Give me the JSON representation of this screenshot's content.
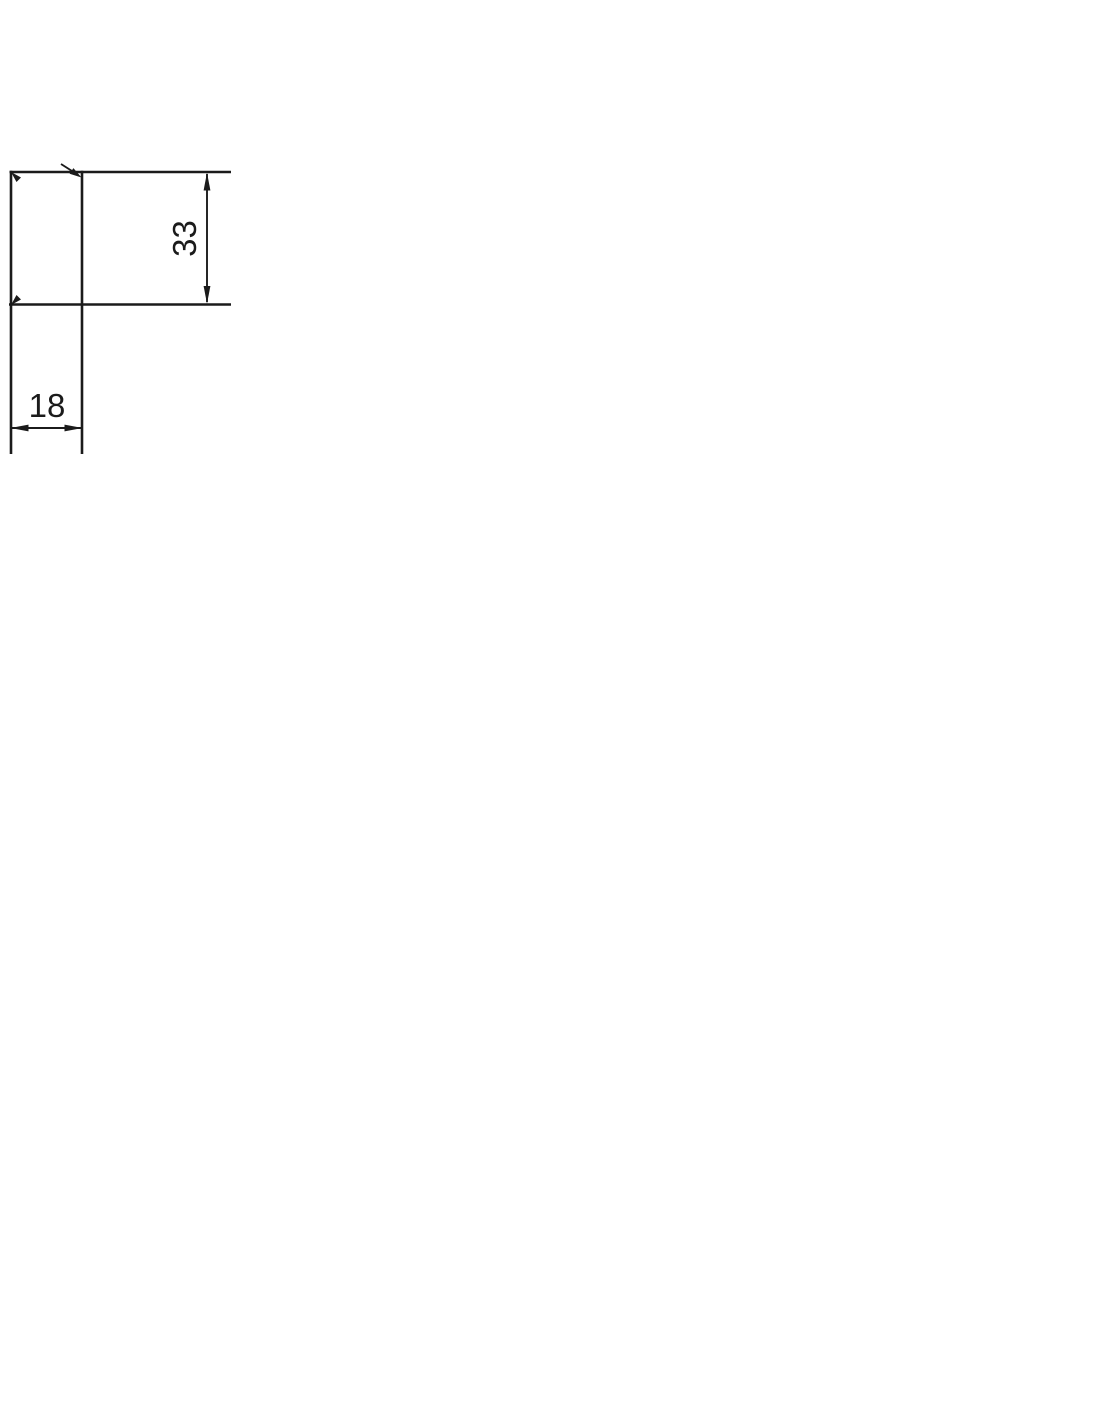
{
  "page": {
    "background_color": "#ffffff"
  },
  "drawing": {
    "kind": "engineering-dimension-drawing-fragment",
    "line_color": "#1b1b1b",
    "labels": {
      "vertical_dimension": "33",
      "horizontal_dimension": "18"
    }
  }
}
